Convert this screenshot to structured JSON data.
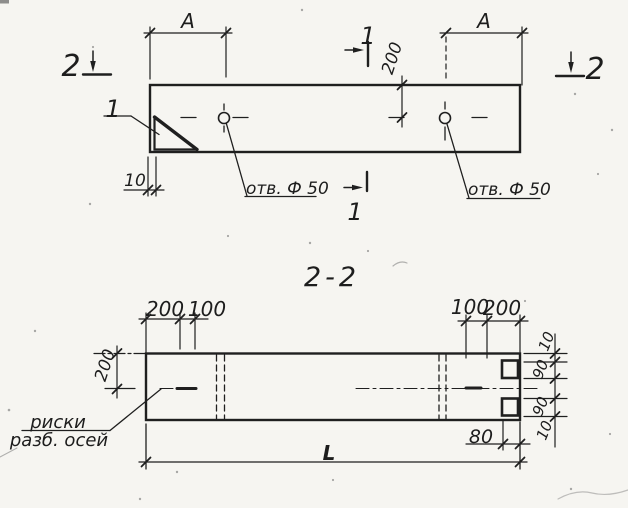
{
  "sheet": {
    "kind": "scanned technical drawing",
    "ink_color": "#1f1f1f",
    "paper_color": "#f6f5f1"
  },
  "plan_view": {
    "dim_a_left": "А",
    "dim_a_right": "А",
    "dim_half_width": "200",
    "dim_edge_offset": "10",
    "hole_label_left": "отв. Ф 50",
    "hole_label_right": "отв. Ф 50",
    "detail_callout": "1",
    "section1_top": "1",
    "section1_bottom": "1",
    "section2_left": "2",
    "section2_right": "2"
  },
  "section_view": {
    "title": "2-2",
    "dim_top_left_200": "200",
    "dim_top_left_100": "100",
    "dim_top_right_100": "100",
    "dim_top_right_200": "200",
    "dim_half_height": "200",
    "dim_right_top_10": "10",
    "dim_right_top_90": "90",
    "dim_right_bottom_90": "90",
    "dim_right_bottom_10": "10",
    "dim_notch_depth": "80",
    "dim_length": "L",
    "axis_marks_line1": "риски",
    "axis_marks_line2": "разб. осей"
  }
}
